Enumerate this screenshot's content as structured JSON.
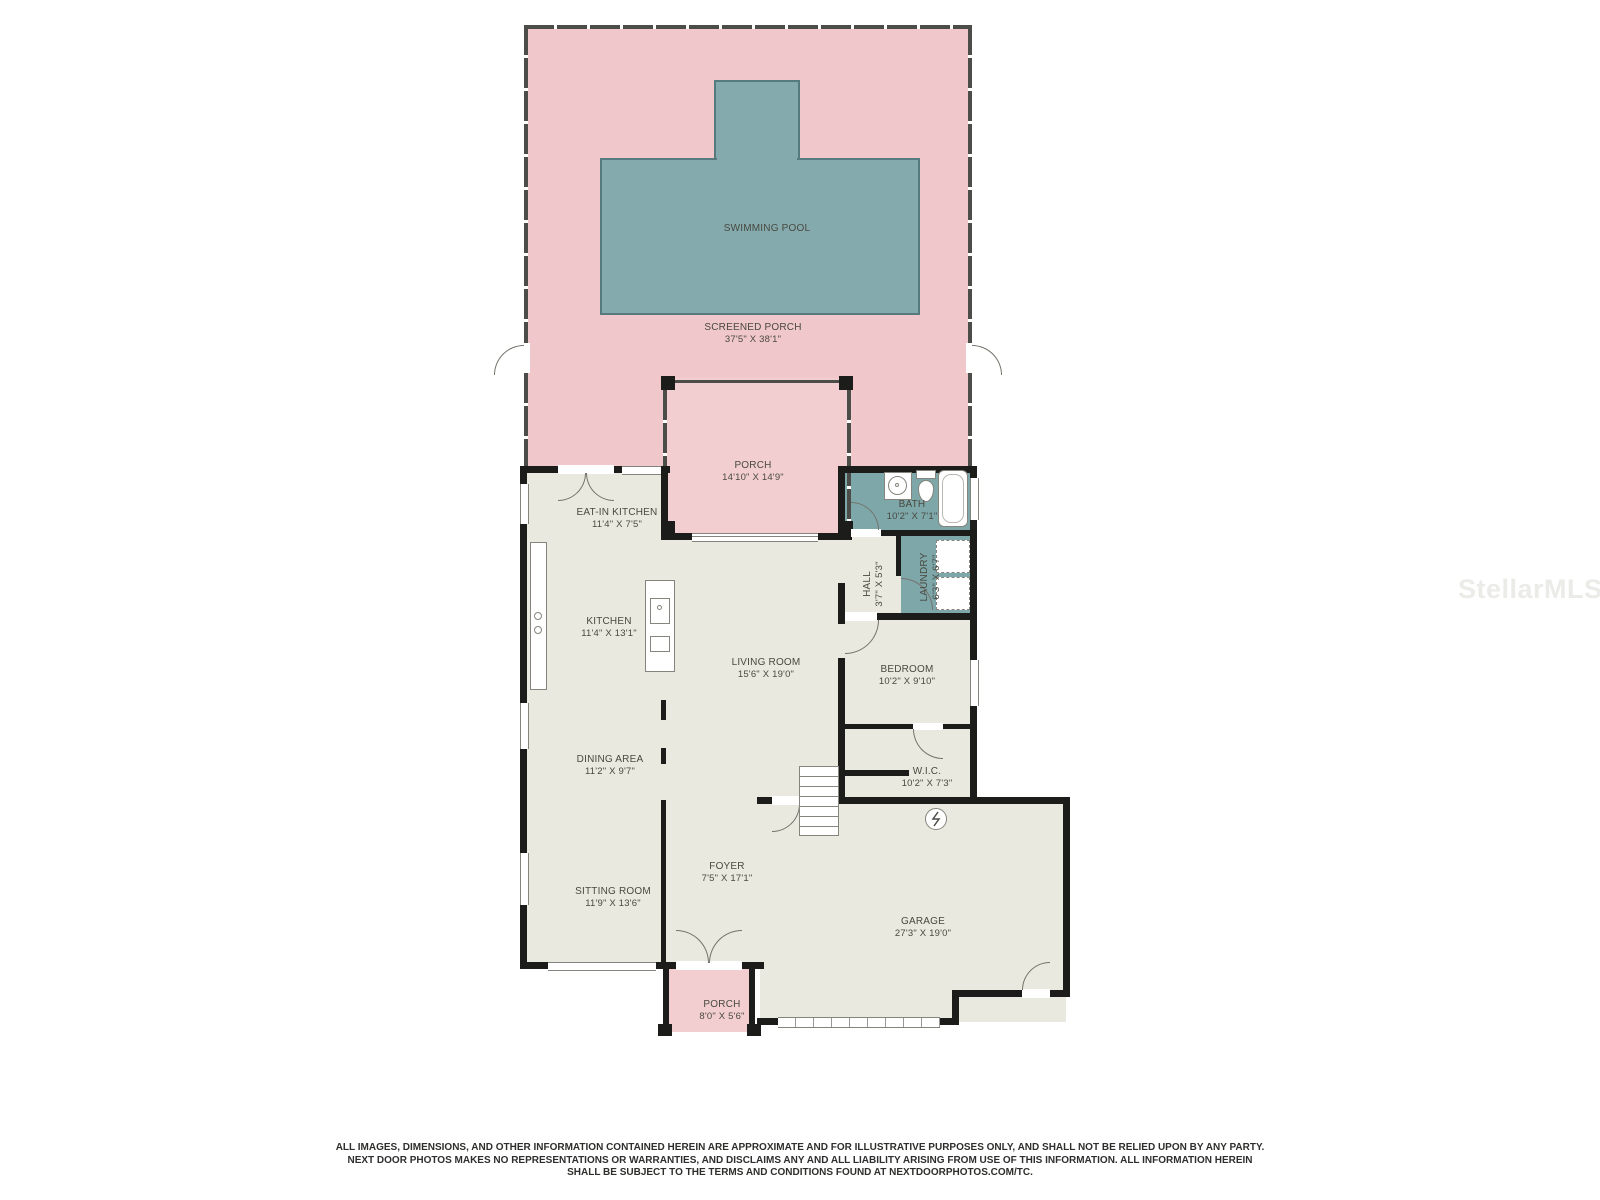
{
  "watermark": "StellarMLS",
  "colors": {
    "pink": "#f0c7ca",
    "pink_light": "#f2ced1",
    "teal_pool": "#84aaad",
    "teal_room": "#7ea7aa",
    "cream": "#eae9df",
    "wall": "#1c1c1a"
  },
  "rooms": {
    "swimming_pool": {
      "name": "SWIMMING POOL",
      "dims": ""
    },
    "screened_porch": {
      "name": "SCREENED PORCH",
      "dims": "37'5\" X 38'1\""
    },
    "porch_upper": {
      "name": "PORCH",
      "dims": "14'10\" X 14'9\""
    },
    "eat_in_kitchen": {
      "name": "EAT-IN KITCHEN",
      "dims": "11'4\" X 7'5\""
    },
    "bath": {
      "name": "BATH",
      "dims": "10'2\" X 7'1\""
    },
    "laundry": {
      "name": "LAUNDRY",
      "dims": "6'3\" X 6'7\""
    },
    "hall": {
      "name": "HALL",
      "dims": "3'7\" X 5'3\""
    },
    "kitchen": {
      "name": "KITCHEN",
      "dims": "11'4\" X 13'1\""
    },
    "living_room": {
      "name": "LIVING ROOM",
      "dims": "15'6\" X 19'0\""
    },
    "bedroom": {
      "name": "BEDROOM",
      "dims": "10'2\" X 9'10\""
    },
    "dining_area": {
      "name": "DINING AREA",
      "dims": "11'2\" X 9'7\""
    },
    "wic": {
      "name": "W.I.C.",
      "dims": "10'2\" X 7'3\""
    },
    "sitting_room": {
      "name": "SITTING ROOM",
      "dims": "11'9\" X 13'6\""
    },
    "foyer": {
      "name": "FOYER",
      "dims": "7'5\" X 17'1\""
    },
    "garage": {
      "name": "GARAGE",
      "dims": "27'3\" X 19'0\""
    },
    "porch_lower": {
      "name": "PORCH",
      "dims": "8'0\" X 5'6\""
    }
  },
  "disclaimer": {
    "line1": "ALL IMAGES, DIMENSIONS, AND OTHER INFORMATION CONTAINED HEREIN ARE APPROXIMATE AND FOR ILLUSTRATIVE PURPOSES ONLY, AND SHALL NOT BE RELIED UPON BY ANY PARTY.",
    "line2": "NEXT DOOR PHOTOS MAKES NO REPRESENTATIONS OR WARRANTIES, AND DISCLAIMS ANY AND ALL LIABILITY ARISING FROM USE OF THIS INFORMATION. ALL INFORMATION HEREIN",
    "line3": "SHALL BE SUBJECT TO THE TERMS AND CONDITIONS FOUND AT NEXTDOORPHOTOS.COM/TC."
  }
}
